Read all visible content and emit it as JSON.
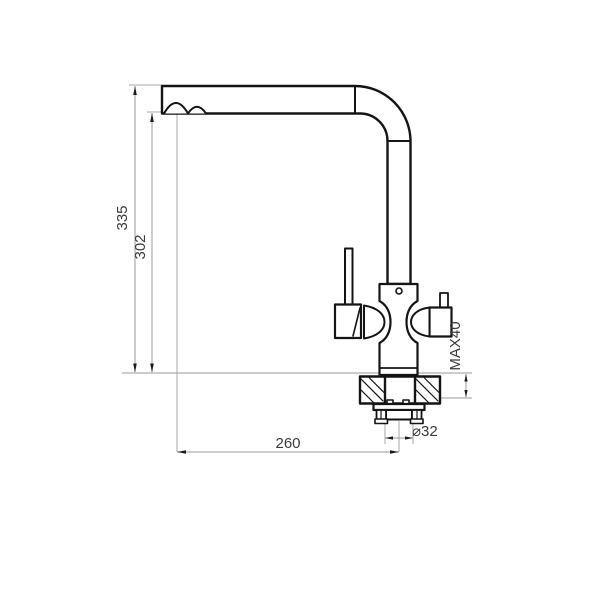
{
  "drawing": {
    "type": "technical-dimension-drawing",
    "subject": "kitchen-faucet-side-view",
    "colors": {
      "outline": "#141414",
      "dimension_line": "#999999",
      "extension_line": "#aaaaaa",
      "text": "#3a3a3a",
      "background": "#ffffff"
    },
    "dims": {
      "total_height": "335",
      "spout_height": "302",
      "spout_reach": "260",
      "hole_diameter": "⌀32",
      "max_mount_thickness": "MAX40"
    }
  }
}
